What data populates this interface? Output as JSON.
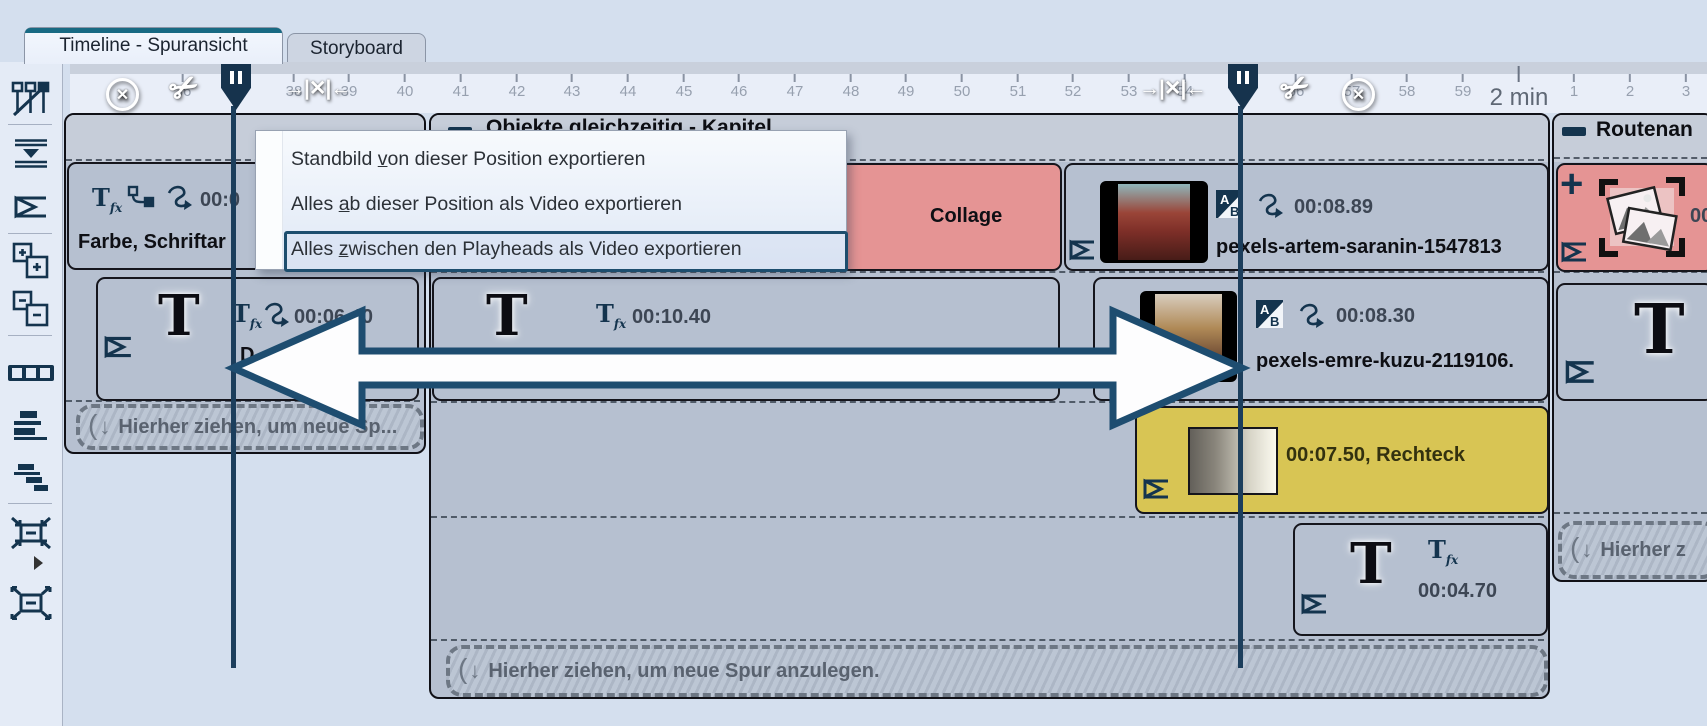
{
  "tabs": [
    {
      "label": "Timeline - Spuransicht"
    },
    {
      "label": "Storyboard"
    }
  ],
  "ruler": {
    "minute_label": "2 min",
    "ticks": [
      {
        "label": "36",
        "x": 183
      },
      {
        "label": "37",
        "x": 238
      },
      {
        "label": "38",
        "x": 294
      },
      {
        "label": "39",
        "x": 349
      },
      {
        "label": "40",
        "x": 405
      },
      {
        "label": "41",
        "x": 461
      },
      {
        "label": "42",
        "x": 517
      },
      {
        "label": "43",
        "x": 572
      },
      {
        "label": "44",
        "x": 628
      },
      {
        "label": "45",
        "x": 684
      },
      {
        "label": "46",
        "x": 739
      },
      {
        "label": "47",
        "x": 795
      },
      {
        "label": "48",
        "x": 851
      },
      {
        "label": "49",
        "x": 906
      },
      {
        "label": "50",
        "x": 962
      },
      {
        "label": "51",
        "x": 1018
      },
      {
        "label": "52",
        "x": 1073
      },
      {
        "label": "53",
        "x": 1129
      },
      {
        "label": "54",
        "x": 1185
      },
      {
        "label": "55",
        "x": 1240
      },
      {
        "label": "56",
        "x": 1296
      },
      {
        "label": "57",
        "x": 1352
      },
      {
        "label": "58",
        "x": 1407
      },
      {
        "label": "59",
        "x": 1463
      },
      {
        "label": "2 min",
        "x": 1519,
        "major": true
      },
      {
        "label": "1",
        "x": 1574
      },
      {
        "label": "2",
        "x": 1630
      },
      {
        "label": "3",
        "x": 1686
      }
    ]
  },
  "menu": {
    "items": [
      {
        "pre": "Standbild ",
        "key": "v",
        "post": "on dieser Position exportieren"
      },
      {
        "pre": "Alles ",
        "key": "a",
        "post": "b dieser Position als Video exportieren"
      },
      {
        "pre": "Alles ",
        "key": "z",
        "post": "wischen den Playheads als Video exportieren"
      }
    ]
  },
  "sections": {
    "left": {
      "clip_farbe": {
        "duration": "00:0",
        "title": "Farbe, Schriftar"
      },
      "clip_text": {
        "duration": "00:06.40",
        "partial_title": "D"
      },
      "dropzone": "Hierher ziehen, um neue Sp..."
    },
    "middle": {
      "title": "Objekte gleichzeitig - Kapitel",
      "collage": {
        "title": "Collage"
      },
      "artem": {
        "duration": "00:08.89",
        "filename": "pexels-artem-saranin-1547813"
      },
      "text_clip": {
        "duration": "00:10.40"
      },
      "emre": {
        "duration": "00:08.30",
        "filename": "pexels-emre-kuzu-2119106."
      },
      "rect_clip": {
        "label": "00:07.50, Rechteck"
      },
      "text_clip2": {
        "duration": "00:04.70"
      },
      "dropzone": "Hierher ziehen, um neue Spur anzulegen."
    },
    "right": {
      "title": "Routenan",
      "media_clip": {
        "duration": "00"
      },
      "dropzone": "Hierher z"
    }
  },
  "glyphs": {
    "big_t": "T",
    "tfx_t": "T",
    "tfx_fx": "fx",
    "ab_a": "A",
    "ab_b": "B",
    "plus": "+",
    "down_arrow": "↓",
    "paren": "(",
    "scissors": "✂",
    "x": "✕",
    "gap": "→|✕|←"
  },
  "colors": {
    "accent_teal": "#186a83",
    "icon_navy": "#14344e",
    "clip_red": "#e59494",
    "clip_yellow": "#d8c554",
    "playhead": "#1c3e5c"
  }
}
